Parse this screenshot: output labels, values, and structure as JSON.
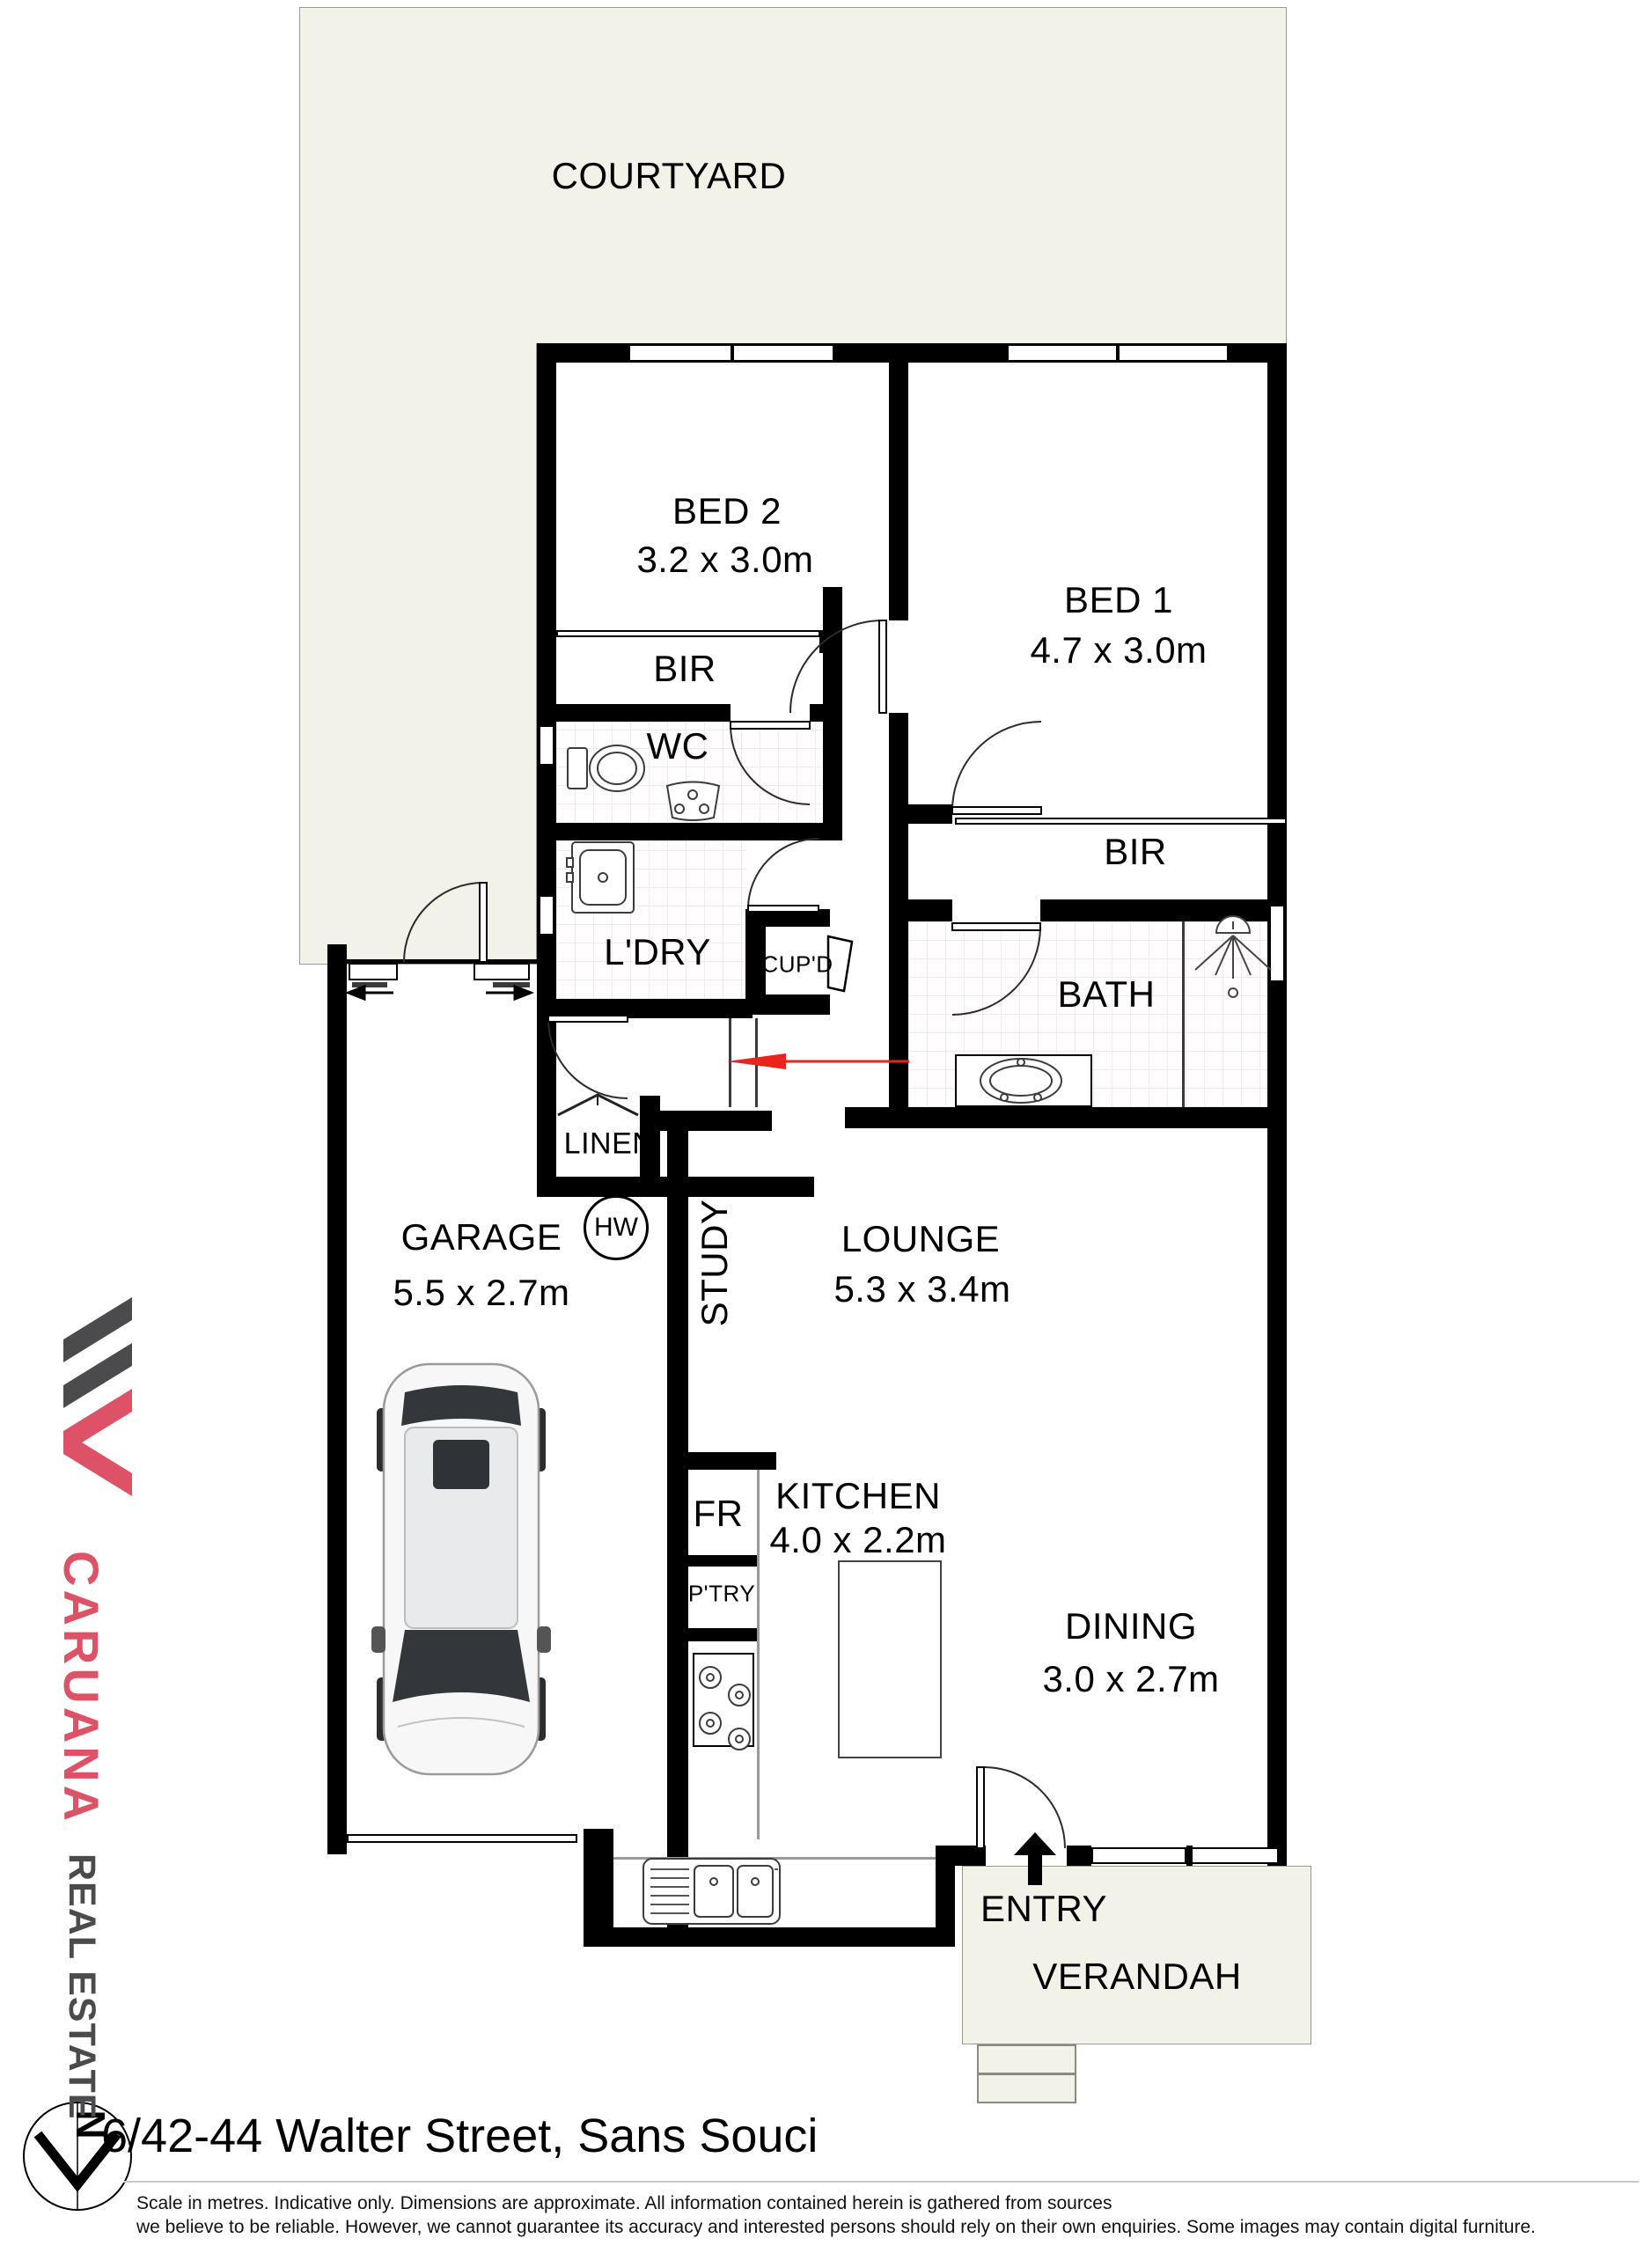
{
  "page": {
    "address": "6/42-44 Walter Street, Sans Souci",
    "disclaimer_line1": "Scale in metres. Indicative only. Dimensions are approximate. All information contained herein is gathered from sources",
    "disclaimer_line2": "we believe to be reliable. However, we cannot guarantee its accuracy and interested persons should rely on their own enquiries. Some images may contain digital furniture."
  },
  "branding": {
    "agency_name": "CARUANA",
    "agency_suffix": "REAL ESTATE",
    "brand_color": "#DD5266",
    "brand_dark": "#4B4B4D"
  },
  "compass": {
    "north_label": "N"
  },
  "colors": {
    "courtyard_fill": "#F2F2E9",
    "wall": "#000000",
    "direction_arrow_red": "#E8241C"
  },
  "rooms": {
    "courtyard": {
      "name": "COURTYARD"
    },
    "bed2": {
      "name": "BED 2",
      "dims": "3.2 x 3.0m"
    },
    "bed1": {
      "name": "BED 1",
      "dims": "4.7 x 3.0m"
    },
    "bir_bed2": {
      "name": "BIR"
    },
    "bir_bed1": {
      "name": "BIR"
    },
    "wc": {
      "name": "WC"
    },
    "laundry": {
      "name": "L'DRY"
    },
    "cupboard": {
      "name": "CUP'D"
    },
    "bath": {
      "name": "BATH"
    },
    "linen": {
      "name": "LINEN"
    },
    "hot_water": {
      "name": "HW"
    },
    "garage": {
      "name": "GARAGE",
      "dims": "5.5 x 2.7m"
    },
    "study": {
      "name": "STUDY"
    },
    "lounge": {
      "name": "LOUNGE",
      "dims": "5.3 x 3.4m"
    },
    "kitchen": {
      "name": "KITCHEN",
      "dims": "4.0 x 2.2m"
    },
    "fridge": {
      "name": "FR"
    },
    "pantry": {
      "name": "P'TRY"
    },
    "dining": {
      "name": "DINING",
      "dims": "3.0 x 2.7m"
    },
    "entry": {
      "name": "ENTRY"
    },
    "verandah": {
      "name": "VERANDAH"
    }
  }
}
